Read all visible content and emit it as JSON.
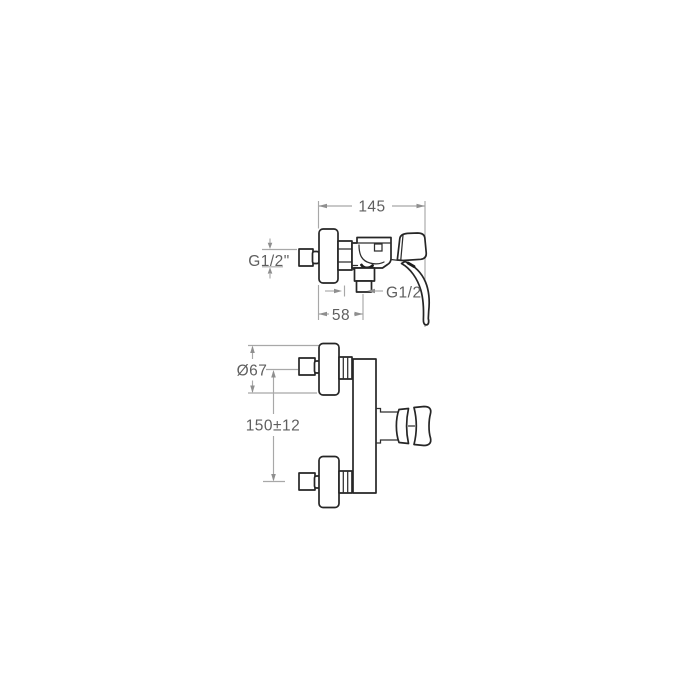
{
  "drawing": {
    "title": "wall-mounted single-lever shower mixer - dimension drawing",
    "background": "#ffffff",
    "colors": {
      "outline": "#262626",
      "dimension_line": "#a8a8a8",
      "dimension_text": "#5f5f5f"
    },
    "views": {
      "side_view": {
        "dimensions": {
          "total_depth": {
            "label": "145"
          },
          "inlet_thread": {
            "label": "G1/2\""
          },
          "outlet_thread": {
            "label": "G1/2"
          },
          "wall_to_outlet": {
            "label": "58"
          }
        }
      },
      "front_view": {
        "dimensions": {
          "flange_diameter": {
            "label": "Ø67"
          },
          "inlet_spacing": {
            "label": "150±12"
          }
        }
      }
    }
  }
}
